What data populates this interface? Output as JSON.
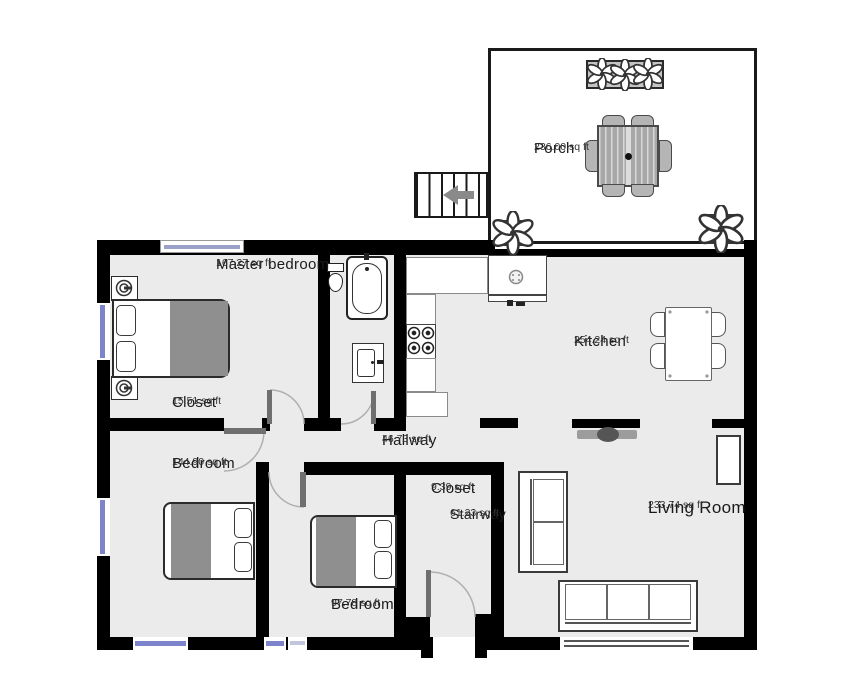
{
  "meta": {
    "type": "residential-floor-plan",
    "view": "top-down"
  },
  "rooms": {
    "porch": {
      "name": "Porch",
      "area": "236.00 sq ft"
    },
    "master_bedroom": {
      "name": "Master bedroom",
      "area": "167.27 sq ft"
    },
    "master_closet": {
      "name": "Closet",
      "area": "15.51 sq ft"
    },
    "bedroom_large": {
      "name": "Bedroom",
      "area": "144.90 sq ft"
    },
    "hallway": {
      "name": "Hallway",
      "area": "46.73 sq ft"
    },
    "kitchen": {
      "name": "Kitchen",
      "area": "254.24 sq ft"
    },
    "entry_closet": {
      "name": "Closet",
      "area": "9.39 sq ft"
    },
    "stairway": {
      "name": "Stairway",
      "area": "61.23 sq ft"
    },
    "bedroom_small": {
      "name": "Bedroom",
      "area": "97.78 sq ft"
    },
    "living_room": {
      "name": "Living Room",
      "area": "233.74 sq ft"
    }
  },
  "colors": {
    "wall": "#000000",
    "floor": "#ebebeb",
    "window_glass": "#7d84cb",
    "bed_blanket": "#8f8f8f",
    "door_leaf": "#6f6f6f",
    "door_arc": "#b0b0b0"
  },
  "furniture_icons": [
    "double-bed",
    "nightstand-lamp",
    "bathtub",
    "toilet",
    "vanity-sink",
    "kitchen-counter",
    "stove-four-burners",
    "kitchen-sink",
    "dining-table-four-chairs",
    "tv",
    "loveseat",
    "sofa",
    "cabinet",
    "outdoor-dining-set",
    "planter-box",
    "potted-plant",
    "exterior-stairs",
    "direction-arrow"
  ]
}
